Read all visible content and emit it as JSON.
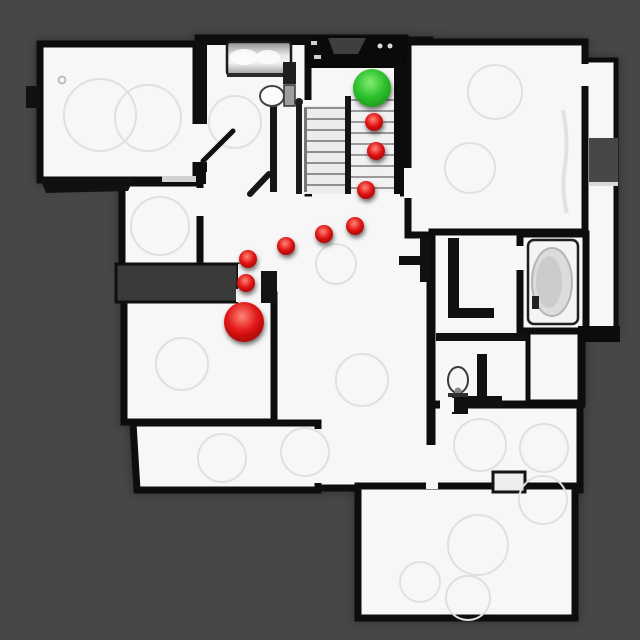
{
  "map": {
    "title": "top-down-house-scan-with-navigation-trajectory",
    "colors": {
      "background": "#474747",
      "floor": "#f7f7f7",
      "wall": "#0d0d0d",
      "wall_soft": "#3a3a3a",
      "artifact_stroke": "#e0e0e0",
      "goal_green_light": "#84ec72",
      "goal_green_mid": "#2fc32f",
      "goal_green_dark": "#128c15",
      "path_red_light": "#ff8678",
      "path_red_mid": "#e01414",
      "path_red_dark": "#8f0202"
    },
    "goal_marker": {
      "x": 372,
      "y": 88,
      "r": 19
    },
    "agent_marker": {
      "x": 244,
      "y": 322,
      "r": 20
    },
    "waypoint_radius": 9,
    "waypoints": [
      {
        "x": 374,
        "y": 122
      },
      {
        "x": 376,
        "y": 151
      },
      {
        "x": 366,
        "y": 190
      },
      {
        "x": 355,
        "y": 226
      },
      {
        "x": 324,
        "y": 234
      },
      {
        "x": 286,
        "y": 246
      },
      {
        "x": 248,
        "y": 259
      },
      {
        "x": 246,
        "y": 283
      }
    ]
  }
}
